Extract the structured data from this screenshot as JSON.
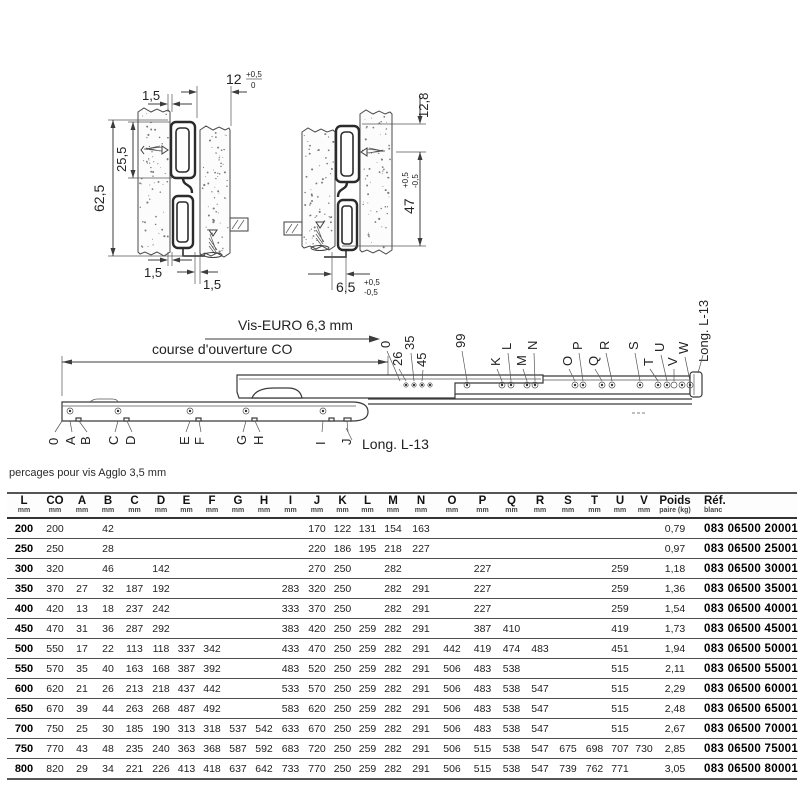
{
  "drawings": {
    "left_section": {
      "gap_top": "1,5",
      "width_top": "12",
      "width_top_tol_plus": "+0,5",
      "width_top_tol_minus": "0",
      "rail_height": "25,5",
      "total_height": "62,5",
      "gap_bottom_left": "1,5",
      "gap_bottom_center": "1,5"
    },
    "right_section": {
      "top_offset": "12,8",
      "height": "47",
      "height_tol_plus": "+0,5",
      "height_tol_minus": "-0,5",
      "bottom_gap": "6,5",
      "bottom_gap_tol_plus": "+0,5",
      "bottom_gap_tol_minus": "-0,5"
    },
    "side_view": {
      "screw_label": "Vis-EURO 6,3 mm",
      "travel_label": "course d'ouverture CO",
      "length_label_bottom": "Long. L-13",
      "length_label_top": "Long. L-13",
      "bottom_hole_labels": [
        "0",
        "A",
        "B",
        "C",
        "D",
        "E",
        "F",
        "G",
        "H",
        "I",
        "J"
      ],
      "top_hole_labels": [
        "0",
        "26",
        "35",
        "45",
        "99",
        "K",
        "L",
        "M",
        "N",
        "O",
        "P",
        "Q",
        "R",
        "S",
        "T",
        "U",
        "V",
        "W"
      ]
    }
  },
  "table": {
    "note": "percages pour vis Agglo 3,5 mm",
    "columns": [
      {
        "label": "L",
        "unit": "mm"
      },
      {
        "label": "CO",
        "unit": "mm"
      },
      {
        "label": "A",
        "unit": "mm"
      },
      {
        "label": "B",
        "unit": "mm"
      },
      {
        "label": "C",
        "unit": "mm"
      },
      {
        "label": "D",
        "unit": "mm"
      },
      {
        "label": "E",
        "unit": "mm"
      },
      {
        "label": "F",
        "unit": "mm"
      },
      {
        "label": "G",
        "unit": "mm"
      },
      {
        "label": "H",
        "unit": "mm"
      },
      {
        "label": "I",
        "unit": "mm"
      },
      {
        "label": "J",
        "unit": "mm"
      },
      {
        "label": "K",
        "unit": "mm"
      },
      {
        "label": "L",
        "unit": "mm"
      },
      {
        "label": "M",
        "unit": "mm"
      },
      {
        "label": "N",
        "unit": "mm"
      },
      {
        "label": "O",
        "unit": "mm"
      },
      {
        "label": "P",
        "unit": "mm"
      },
      {
        "label": "Q",
        "unit": "mm"
      },
      {
        "label": "R",
        "unit": "mm"
      },
      {
        "label": "S",
        "unit": "mm"
      },
      {
        "label": "T",
        "unit": "mm"
      },
      {
        "label": "U",
        "unit": "mm"
      },
      {
        "label": "V",
        "unit": "mm"
      },
      {
        "label": "Poids",
        "unit": "paire (kg)"
      },
      {
        "label": "Réf.",
        "unit": "blanc"
      }
    ],
    "rows": [
      [
        "200",
        "200",
        "",
        "42",
        "",
        "",
        "",
        "",
        "",
        "",
        "",
        "170",
        "122",
        "131",
        "154",
        "163",
        "",
        "",
        "",
        "",
        "",
        "",
        "",
        "",
        "0,79",
        "083 06500 20001"
      ],
      [
        "250",
        "250",
        "",
        "28",
        "",
        "",
        "",
        "",
        "",
        "",
        "",
        "220",
        "186",
        "195",
        "218",
        "227",
        "",
        "",
        "",
        "",
        "",
        "",
        "",
        "",
        "0,97",
        "083 06500 25001"
      ],
      [
        "300",
        "320",
        "",
        "46",
        "",
        "142",
        "",
        "",
        "",
        "",
        "",
        "270",
        "250",
        "",
        "282",
        "",
        "",
        "227",
        "",
        "",
        "",
        "",
        "259",
        "",
        "1,18",
        "083 06500 30001"
      ],
      [
        "350",
        "370",
        "27",
        "32",
        "187",
        "192",
        "",
        "",
        "",
        "",
        "283",
        "320",
        "250",
        "",
        "282",
        "291",
        "",
        "227",
        "",
        "",
        "",
        "",
        "259",
        "",
        "1,36",
        "083 06500 35001"
      ],
      [
        "400",
        "420",
        "13",
        "18",
        "237",
        "242",
        "",
        "",
        "",
        "",
        "333",
        "370",
        "250",
        "",
        "282",
        "291",
        "",
        "227",
        "",
        "",
        "",
        "",
        "259",
        "",
        "1,54",
        "083 06500 40001"
      ],
      [
        "450",
        "470",
        "31",
        "36",
        "287",
        "292",
        "",
        "",
        "",
        "",
        "383",
        "420",
        "250",
        "259",
        "282",
        "291",
        "",
        "387",
        "410",
        "",
        "",
        "",
        "419",
        "",
        "1,73",
        "083 06500 45001"
      ],
      [
        "500",
        "550",
        "17",
        "22",
        "113",
        "118",
        "337",
        "342",
        "",
        "",
        "433",
        "470",
        "250",
        "259",
        "282",
        "291",
        "442",
        "419",
        "474",
        "483",
        "",
        "",
        "451",
        "",
        "1,94",
        "083 06500 50001"
      ],
      [
        "550",
        "570",
        "35",
        "40",
        "163",
        "168",
        "387",
        "392",
        "",
        "",
        "483",
        "520",
        "250",
        "259",
        "282",
        "291",
        "506",
        "483",
        "538",
        "",
        "",
        "",
        "515",
        "",
        "2,11",
        "083 06500 55001"
      ],
      [
        "600",
        "620",
        "21",
        "26",
        "213",
        "218",
        "437",
        "442",
        "",
        "",
        "533",
        "570",
        "250",
        "259",
        "282",
        "291",
        "506",
        "483",
        "538",
        "547",
        "",
        "",
        "515",
        "",
        "2,29",
        "083 06500 60001"
      ],
      [
        "650",
        "670",
        "39",
        "44",
        "263",
        "268",
        "487",
        "492",
        "",
        "",
        "583",
        "620",
        "250",
        "259",
        "282",
        "291",
        "506",
        "483",
        "538",
        "547",
        "",
        "",
        "515",
        "",
        "2,48",
        "083 06500 65001"
      ],
      [
        "700",
        "750",
        "25",
        "30",
        "185",
        "190",
        "313",
        "318",
        "537",
        "542",
        "633",
        "670",
        "250",
        "259",
        "282",
        "291",
        "506",
        "483",
        "538",
        "547",
        "",
        "",
        "515",
        "",
        "2,67",
        "083 06500 70001"
      ],
      [
        "750",
        "770",
        "43",
        "48",
        "235",
        "240",
        "363",
        "368",
        "587",
        "592",
        "683",
        "720",
        "250",
        "259",
        "282",
        "291",
        "506",
        "515",
        "538",
        "547",
        "675",
        "698",
        "707",
        "730",
        "2,85",
        "083 06500 75001"
      ],
      [
        "800",
        "820",
        "29",
        "34",
        "221",
        "226",
        "413",
        "418",
        "637",
        "642",
        "733",
        "770",
        "250",
        "259",
        "282",
        "291",
        "506",
        "515",
        "538",
        "547",
        "739",
        "762",
        "771",
        "",
        "3,05",
        "083 06500 80001"
      ]
    ]
  }
}
